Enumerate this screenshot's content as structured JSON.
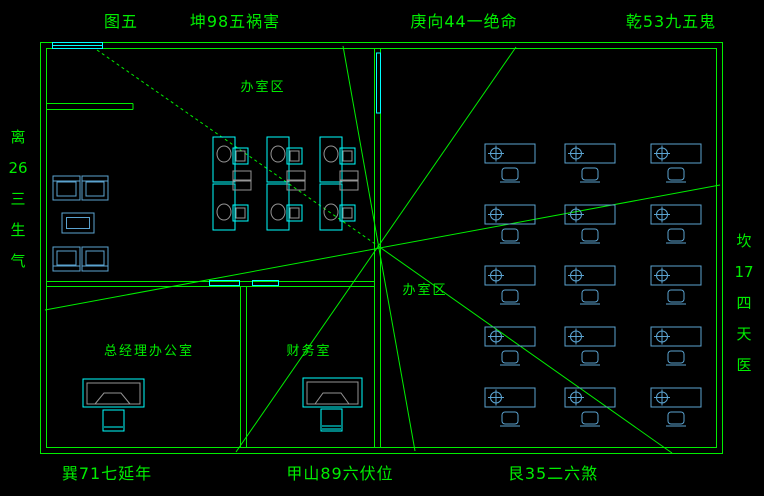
{
  "title": "feng-shui office floor plan (CAD drawing)",
  "colors": {
    "bg": "#000000",
    "green": "#00ee00",
    "cyan": "#00ffff",
    "blue": "#5ba3d0",
    "gray": "#959595"
  },
  "labels": {
    "top": [
      {
        "text": "图五",
        "x": 121
      },
      {
        "text": "坤98五祸害",
        "x": 235
      },
      {
        "text": "庚向44一绝命",
        "x": 464
      },
      {
        "text": "乾53九五鬼",
        "x": 671
      }
    ],
    "bottom": [
      {
        "text": "巽71七延年",
        "x": 107
      },
      {
        "text": "甲山89六伏位",
        "x": 340
      },
      {
        "text": "艮35二六煞",
        "x": 553
      }
    ],
    "left_column": [
      "离",
      "26",
      "三",
      "生",
      "气"
    ],
    "right_column": [
      "坎",
      "17",
      "四",
      "天",
      "医"
    ],
    "rooms": [
      {
        "text": "办室区",
        "x": 263,
        "y": 88
      },
      {
        "text": "办室区",
        "x": 425,
        "y": 291
      },
      {
        "text": "总经理办公室",
        "x": 149,
        "y": 352
      },
      {
        "text": "财务室",
        "x": 309,
        "y": 352
      }
    ]
  },
  "floorplan": {
    "open_office_desk_grid": {
      "count": 15,
      "cols_x": [
        485,
        565,
        651
      ],
      "rows_y": [
        144,
        205,
        266,
        327,
        388
      ],
      "desk_w": 50,
      "desk_h": 19,
      "symbol": "crosshair-target-icon",
      "chair_position": "below-desk"
    },
    "workstation_cluster": {
      "count": 6,
      "cols_x": [
        213,
        267,
        320
      ],
      "top_desk_y": 137,
      "bottom_desk_y": 184,
      "desk_w": 22,
      "desk_h": 45
    },
    "rays_center": {
      "x": 381,
      "y": 248
    }
  }
}
